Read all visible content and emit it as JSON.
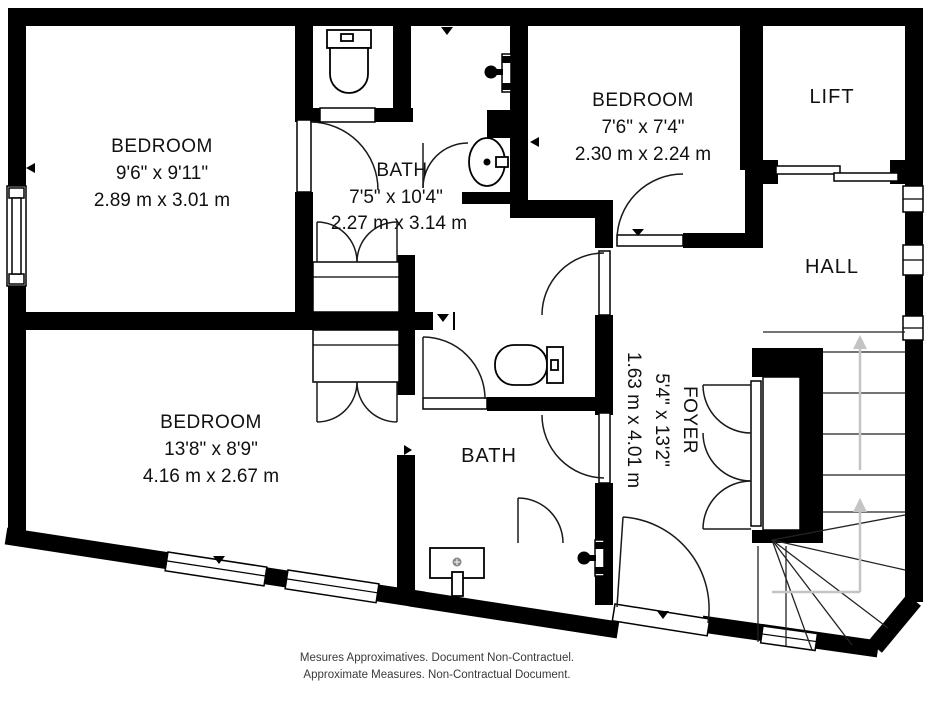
{
  "title": "Floor plan",
  "rooms": [
    {
      "id": "bedroom-1",
      "name": "BEDROOM",
      "imperial": "9'6\" x 9'11\"",
      "metric": "2.89 m x 3.01 m"
    },
    {
      "id": "bath-1",
      "name": "BATH",
      "imperial": "7'5\" x 10'4\"",
      "metric": "2.27 m x 3.14 m"
    },
    {
      "id": "bedroom-2",
      "name": "BEDROOM",
      "imperial": "7'6\" x 7'4\"",
      "metric": "2.30 m x 2.24 m"
    },
    {
      "id": "lift",
      "name": "LIFT"
    },
    {
      "id": "hall",
      "name": "HALL"
    },
    {
      "id": "bedroom-3",
      "name": "BEDROOM",
      "imperial": "13'8\" x 8'9\"",
      "metric": "4.16 m x 2.67 m"
    },
    {
      "id": "bath-2",
      "name": "BATH"
    },
    {
      "id": "foyer",
      "name": "FOYER",
      "imperial": "5'4\" x 13'2\"",
      "metric": "1.63 m x 4.01 m"
    }
  ],
  "disclaimer": {
    "line1": "Mesures Approximatives. Document Non-Contractuel.",
    "line2": "Approximate Measures. Non-Contractual Document."
  },
  "colors": {
    "wall": "#000000",
    "background": "#ffffff",
    "stair_arrow": "#c4c4c4",
    "text": "#111111",
    "disclaimer_text": "#3a3a3a"
  },
  "icons": [
    "toilet-icon",
    "sink-icon",
    "shower-head-icon",
    "door-swing-icon",
    "window-icon",
    "staircase-icon",
    "lift-sliding-doors-icon",
    "stairs-up-arrow-icon"
  ]
}
